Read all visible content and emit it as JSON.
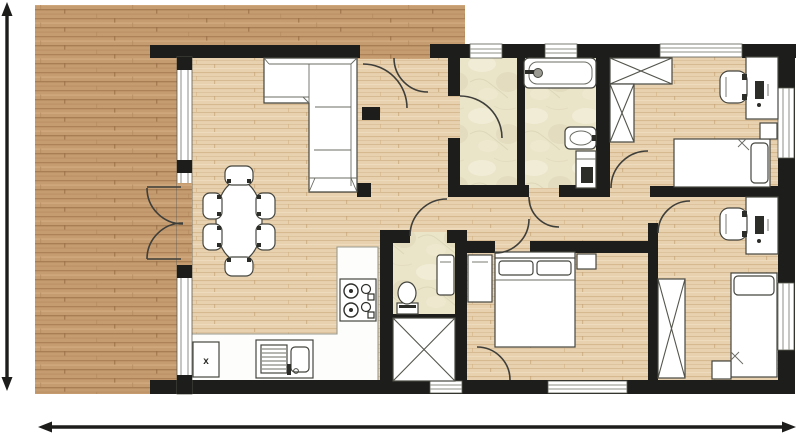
{
  "plan": {
    "title": "Apartment floor plan with wooden terrace",
    "labels": {
      "dishwasher": "x"
    },
    "colors": {
      "wall": "#1d1d1b",
      "terrace_wood": "#c59c70",
      "terrace_wood_grain": "#aa7e54",
      "interior_wood": "#e8d1af",
      "interior_wood_grain": "#d5b88f",
      "bathroom_tile": "#eae4c9",
      "tile_shade": "#dcd5b5",
      "fixture_fill": "#ffffff",
      "fixture_outline": "#45453f",
      "dimension": "#1d1d1b"
    },
    "rooms": [
      "terrace",
      "living-dining-room",
      "kitchen",
      "hallway",
      "storage-room",
      "bathroom",
      "wc",
      "bedroom-top-right",
      "bedroom-middle",
      "bedroom-bottom-right"
    ],
    "furniture": [
      "corner-sofa",
      "dining-table-with-6-chairs",
      "l-shaped-kitchen-counter",
      "stove-4-burners",
      "kitchen-sink",
      "dishwasher",
      "bathtub",
      "washbasin",
      "washing-machine",
      "toilet",
      "wc-washbasin",
      "double-bed-with-nightstand",
      "single-bed-top-right",
      "single-bed-bottom-right",
      "desk-with-chair-top-right",
      "desk-with-chair-bottom-right",
      "x-marked-wardrobes"
    ],
    "dimension_arrows": [
      "vertical-left",
      "horizontal-bottom"
    ]
  }
}
